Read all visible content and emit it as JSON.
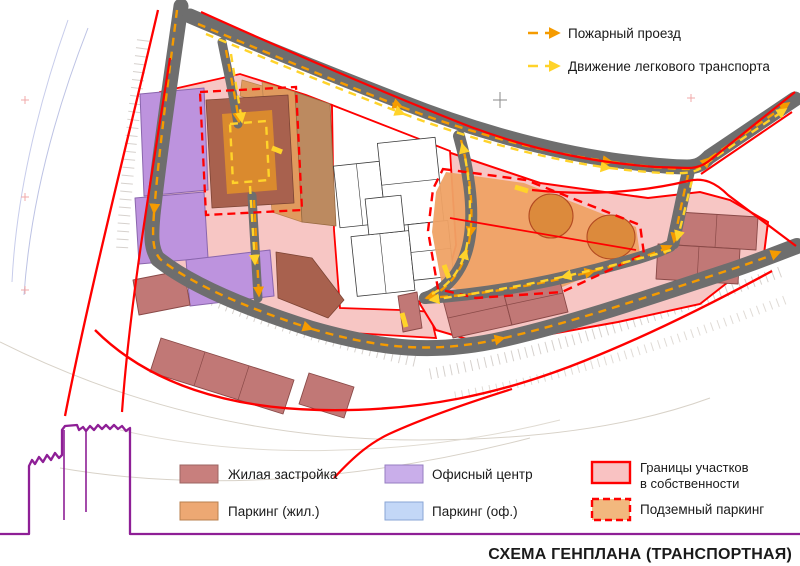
{
  "page": {
    "title": "СХЕМА ГЕНПЛАНА (ТРАНСПОРТНАЯ)"
  },
  "route_legend": {
    "fire": {
      "label": "Пожарный проезд",
      "color": "#f59b00"
    },
    "cars": {
      "label": "Движение легкового транспорта",
      "color": "#ffd32a"
    }
  },
  "area_legend": {
    "residential": {
      "label": "Жилая застройка",
      "color": "#c87f7d"
    },
    "parking_residential": {
      "label": "Паркинг (жил.)",
      "color": "#eda873"
    },
    "office": {
      "label": "Офисный центр",
      "color": "#c9aeea"
    },
    "parking_office": {
      "label": "Паркинг (оф.)",
      "color": "#c3d7f7"
    },
    "ownership": {
      "line1": "Границы участков",
      "line2": "в собственности",
      "fill": "#f9c2c2",
      "border": "#ff0000"
    },
    "underground": {
      "label": "Подземный паркинг",
      "fill": "#f2b87e",
      "border": "#ff0000"
    }
  },
  "map_colors": {
    "road": "#6e6e6e",
    "zone_pink": "#f7c6c4",
    "boundary_red": "#ff0000",
    "office_purple": "#bd93de",
    "residential_red": "#c17876",
    "parking_orange": "#efa265",
    "courtyard_orange": "#da8a2e",
    "maroon_building": "#a8614e",
    "tan_building": "#bc8a60",
    "fire_route": "#f59b00",
    "car_route": "#ffd32a",
    "skyline_purple": "#8e1f96"
  }
}
